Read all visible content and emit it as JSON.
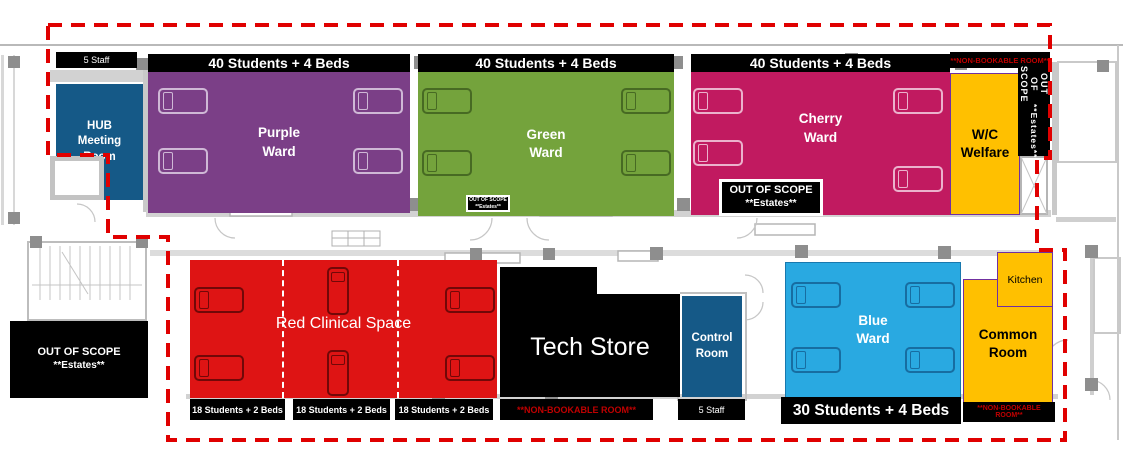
{
  "title": "Hospital simulation ward floor plan",
  "colors": {
    "purple_ward": "#7B3F87",
    "green_ward": "#74A33C",
    "cherry_ward": "#C11A60",
    "red_clinical": "#DE1414",
    "dark_blue_room": "#155987",
    "blue_ward": "#29A9E1",
    "yellow_room": "#FFC000",
    "label_bar": "#000000",
    "boundary_dash": "#E00000",
    "nonbookable_text": "#C00000"
  },
  "top_row": {
    "hub_staff_label": "5 Staff",
    "hub_room": "HUB Meeting Room",
    "purple": {
      "capacity": "40 Students + 4 Beds",
      "name": "Purple Ward"
    },
    "green": {
      "capacity": "40 Students + 4 Beds",
      "name": "Green Ward"
    },
    "cherry": {
      "capacity": "40 Students + 4 Beds",
      "name": "Cherry Ward"
    },
    "nonbookable_note": "**NON-BOOKABLE ROOM**",
    "wc_welfare": "W/C Welfare",
    "estates_vertical": {
      "line1": "OUT OF SCOPE",
      "line2": "**Estates**"
    },
    "estates_small": {
      "line1": "OUT OF SCOPE",
      "line2": "**Estates**"
    },
    "estates_cherry": {
      "line1": "OUT OF SCOPE",
      "line2": "**Estates**"
    }
  },
  "bottom_row": {
    "estates_left": {
      "line1": "OUT OF SCOPE",
      "line2": "**Estates**"
    },
    "red_clinical": {
      "name": "Red Clinical Space",
      "section_labels": [
        "18 Students + 2 Beds",
        "18 Students + 2 Beds",
        "18 Students + 2 Beds"
      ]
    },
    "tech_store": {
      "name": "Tech Store",
      "note": "**NON-BOOKABLE ROOM**"
    },
    "control": {
      "name": "Control Room",
      "label": "5 Staff"
    },
    "blue": {
      "name": "Blue Ward",
      "capacity": "30 Students + 4 Beds"
    },
    "kitchen": "Kitchen",
    "common": {
      "name": "Common Room",
      "note": "**NON-BOOKABLE ROOM**"
    }
  }
}
